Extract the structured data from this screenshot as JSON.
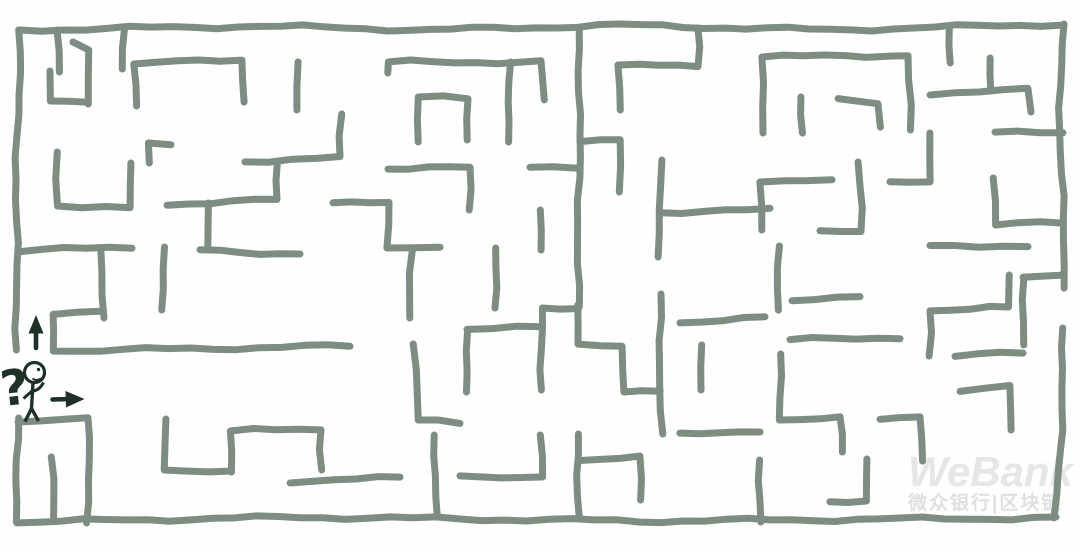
{
  "canvas": {
    "width": 1080,
    "height": 550,
    "background": "#fefefe"
  },
  "maze": {
    "wall_color": "#7e8d81",
    "wall_width": 7,
    "entrance": {
      "side": "left",
      "y_range": [
        352,
        418
      ]
    },
    "exit": {
      "side": "right",
      "y_range": [
        290,
        326
      ]
    },
    "walls": [
      [
        20,
        30,
        260,
        26,
        430,
        30,
        620,
        25,
        830,
        30,
        1062,
        24
      ],
      [
        20,
        30,
        16,
        200,
        17,
        350
      ],
      [
        18,
        418,
        17,
        522
      ],
      [
        17,
        522,
        300,
        517,
        640,
        521,
        900,
        519,
        1056,
        518
      ],
      [
        1062,
        24,
        1060,
        150,
        1066,
        288
      ],
      [
        1064,
        328,
        1060,
        450,
        1056,
        518
      ],
      [
        57,
        30,
        58,
        72
      ],
      [
        88,
        104,
        87,
        50,
        73,
        42
      ],
      [
        50,
        71,
        50,
        101,
        86,
        104
      ],
      [
        123,
        28,
        123,
        69
      ],
      [
        135,
        106,
        135,
        64,
        242,
        59,
        245,
        102
      ],
      [
        150,
        163,
        150,
        143,
        171,
        145
      ],
      [
        167,
        204,
        277,
        200,
        277,
        161
      ],
      [
        207,
        203,
        207,
        247
      ],
      [
        57,
        152,
        58,
        206,
        130,
        209,
        131,
        163
      ],
      [
        18,
        251,
        132,
        247
      ],
      [
        200,
        250,
        300,
        254
      ],
      [
        102,
        249,
        102,
        318
      ],
      [
        296,
        62,
        297,
        110
      ],
      [
        245,
        161,
        340,
        158,
        341,
        114
      ],
      [
        388,
        73,
        389,
        62,
        541,
        62,
        543,
        100
      ],
      [
        580,
        28,
        578,
        307
      ],
      [
        418,
        142,
        419,
        97,
        468,
        98,
        468,
        140
      ],
      [
        509,
        62,
        510,
        142
      ],
      [
        388,
        168,
        470,
        168,
        470,
        210
      ],
      [
        530,
        168,
        578,
        168
      ],
      [
        542,
        210,
        542,
        250
      ],
      [
        333,
        204,
        389,
        203,
        389,
        248,
        440,
        247
      ],
      [
        412,
        250,
        410,
        318
      ],
      [
        620,
        110,
        620,
        65,
        698,
        65,
        698,
        28
      ],
      [
        620,
        140,
        621,
        192
      ],
      [
        580,
        140,
        620,
        140
      ],
      [
        660,
        160,
        660,
        257
      ],
      [
        660,
        212,
        770,
        210
      ],
      [
        495,
        248,
        495,
        308
      ],
      [
        762,
        133,
        762,
        57,
        908,
        55,
        910,
        130
      ],
      [
        802,
        133,
        802,
        97
      ],
      [
        838,
        100,
        878,
        102,
        881,
        127
      ],
      [
        950,
        28,
        950,
        63
      ],
      [
        989,
        58,
        990,
        91
      ],
      [
        930,
        93,
        1028,
        90,
        1031,
        112
      ],
      [
        995,
        133,
        1063,
        133
      ],
      [
        890,
        182,
        930,
        180,
        930,
        133
      ],
      [
        762,
        230,
        762,
        182,
        832,
        179
      ],
      [
        820,
        231,
        861,
        231,
        859,
        162
      ],
      [
        995,
        178,
        995,
        225,
        1063,
        222
      ],
      [
        930,
        247,
        1028,
        245
      ],
      [
        780,
        246,
        777,
        310
      ],
      [
        100,
        310,
        53,
        313,
        55,
        351,
        350,
        346
      ],
      [
        18,
        421,
        88,
        417,
        88,
        523
      ],
      [
        52,
        457,
        53,
        521
      ],
      [
        165,
        419,
        166,
        470,
        230,
        472
      ],
      [
        231,
        472,
        231,
        431,
        321,
        429,
        322,
        470
      ],
      [
        163,
        247,
        163,
        310
      ],
      [
        290,
        481,
        400,
        478
      ],
      [
        542,
        390,
        542,
        308,
        578,
        307
      ],
      [
        578,
        305,
        580,
        344,
        622,
        347,
        622,
        392,
        660,
        390
      ],
      [
        467,
        330,
        542,
        327
      ],
      [
        467,
        330,
        468,
        392
      ],
      [
        415,
        344,
        417,
        420,
        460,
        422
      ],
      [
        660,
        294,
        661,
        434
      ],
      [
        680,
        322,
        765,
        318
      ],
      [
        700,
        345,
        700,
        390
      ],
      [
        435,
        435,
        437,
        517
      ],
      [
        541,
        435,
        541,
        477,
        460,
        478
      ],
      [
        578,
        434,
        579,
        516
      ],
      [
        580,
        460,
        640,
        458,
        641,
        500
      ],
      [
        680,
        435,
        760,
        430
      ],
      [
        792,
        299,
        860,
        297
      ],
      [
        790,
        340,
        900,
        337
      ],
      [
        1010,
        275,
        1010,
        307,
        930,
        310,
        930,
        356
      ],
      [
        1023,
        278,
        1063,
        276
      ],
      [
        1023,
        277,
        1025,
        345
      ],
      [
        960,
        390,
        1010,
        387,
        1010,
        430
      ],
      [
        780,
        354,
        781,
        420,
        840,
        417,
        841,
        452
      ],
      [
        880,
        418,
        920,
        416,
        921,
        461
      ],
      [
        865,
        459,
        866,
        501,
        830,
        503
      ],
      [
        760,
        460,
        761,
        522
      ],
      [
        955,
        356,
        1023,
        353
      ]
    ]
  },
  "figure": {
    "ink_color": "#1e3126",
    "question_mark": "?",
    "pose": "confused stick figure at maze entrance, hand on chin",
    "icons": [
      "question-mark-icon",
      "stick-figure-icon",
      "up-arrow-icon",
      "right-arrow-icon"
    ]
  },
  "watermark": {
    "brand": "WeBank",
    "caption": "微众银行|区块链",
    "brand_color": "#e6e6e6",
    "caption_color": "#e0e0e0"
  }
}
